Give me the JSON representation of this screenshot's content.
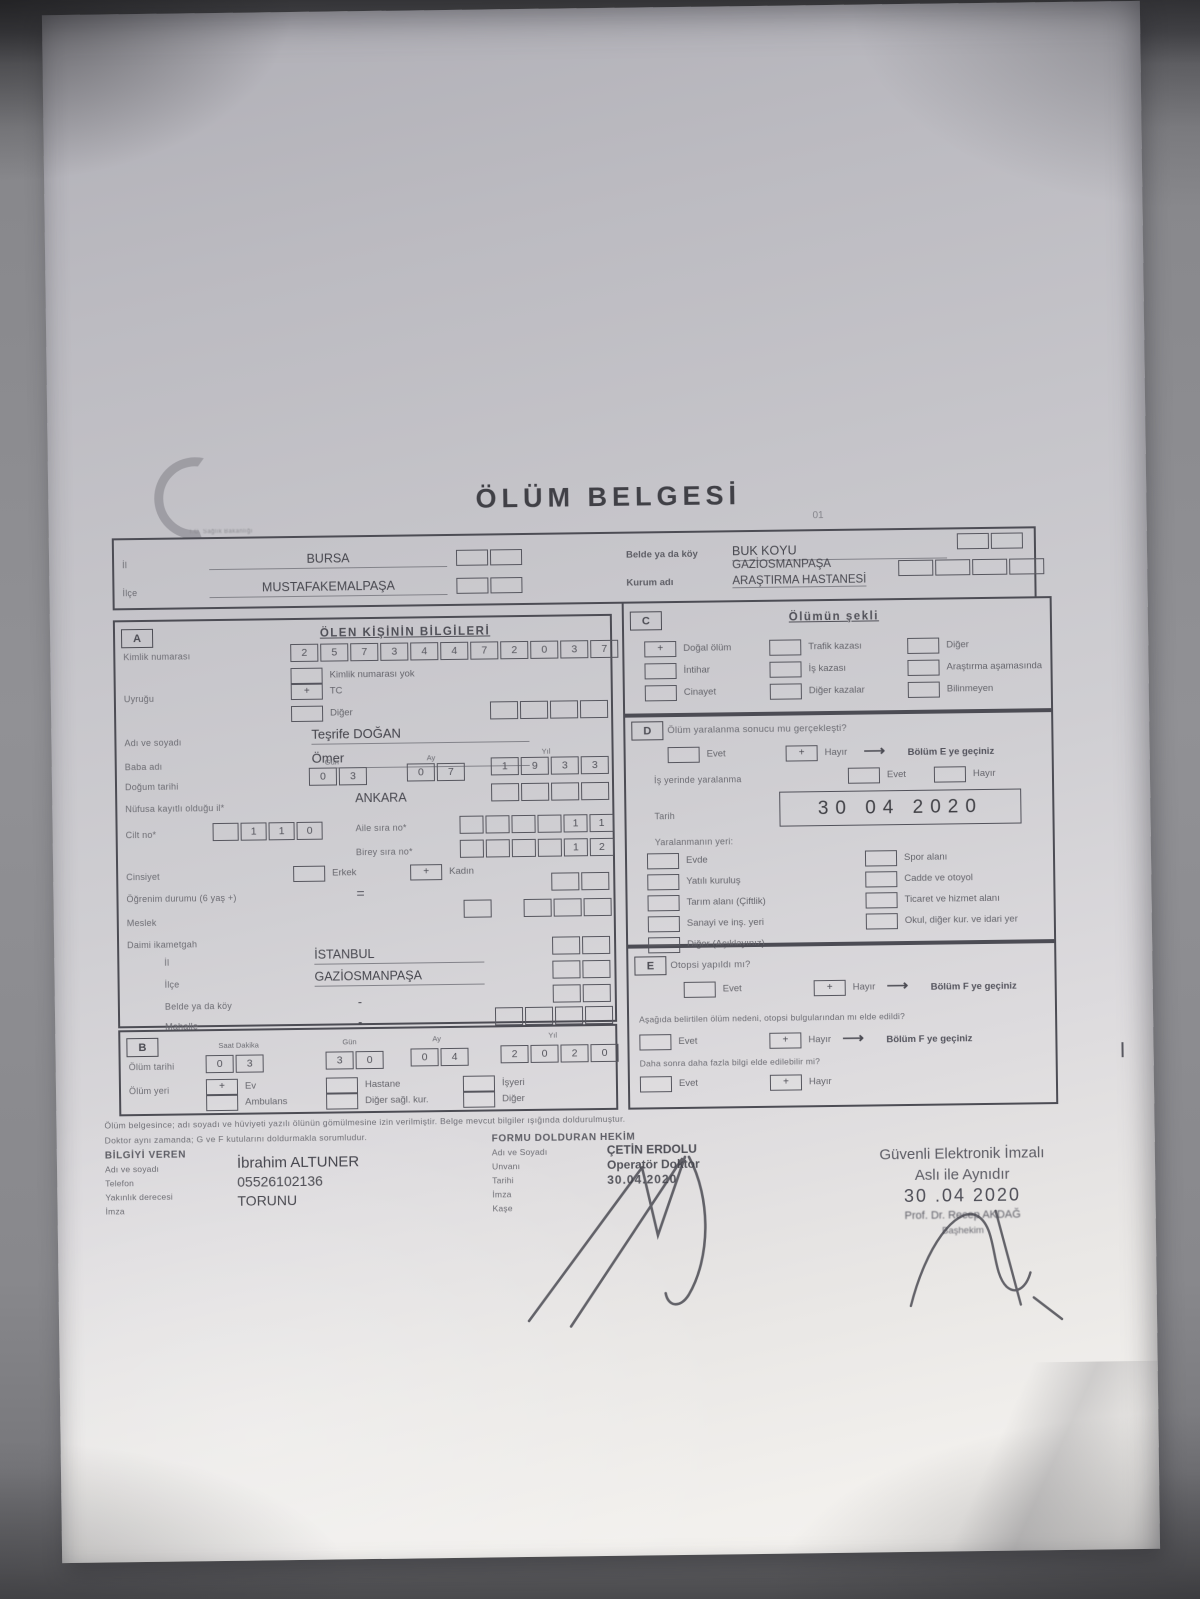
{
  "header": {
    "title": "ÖLÜM BELGESİ",
    "page_code": "01",
    "logo_caption": "T.C. Sağlık Bakanlığı"
  },
  "top_box": {
    "il_label": "İl",
    "il_value": "BURSA",
    "ilce_label": "İlçe",
    "ilce_value": "MUSTAFAKEMALPAŞA",
    "belde_label": "Belde ya da köy",
    "belde_value": "BUK KOYU",
    "kurum_label": "Kurum adı",
    "kurum_value1": "GAZİOSMANPAŞA",
    "kurum_value2": "ARAŞTIRMA HASTANESİ"
  },
  "section_a": {
    "letter": "A",
    "title": "ÖLEN KİŞİNİN BİLGİLERİ",
    "id_label": "Kimlik numarası",
    "id_digits": [
      "2",
      "5",
      "7",
      "3",
      "4",
      "4",
      "7",
      "2",
      "0",
      "3",
      "7"
    ],
    "no_id_label": "Kimlik numarası yok",
    "nationality_label": "Uyruğu",
    "tc_label": "TC",
    "tc_mark": "+",
    "other_label": "Diğer",
    "name_label": "Adı ve soyadı",
    "name_value": "Teşrife DOĞAN",
    "father_label": "Baba adı",
    "father_value": "Ömer",
    "birth_label": "Doğum tarihi",
    "col_day": "Gün",
    "col_month": "Ay",
    "col_year": "Yıl",
    "birth_day": [
      "0",
      "3"
    ],
    "birth_month": [
      "0",
      "7"
    ],
    "birth_year": [
      "1",
      "9",
      "3",
      "3"
    ],
    "registry_label": "Nüfusa kayıtlı olduğu il*",
    "registry_value": "ANKARA",
    "cilt_label": "Cilt no*",
    "cilt_digits": [
      "",
      "1",
      "1",
      "0"
    ],
    "aile_label": "Aile sıra no*",
    "aile_digits": [
      "",
      "",
      "",
      "",
      "1",
      "1"
    ],
    "birey_label": "Birey sıra no*",
    "birey_digits": [
      "",
      "",
      "",
      "",
      "1",
      "2"
    ],
    "gender_label": "Cinsiyet",
    "male_label": "Erkek",
    "female_label": "Kadın",
    "female_mark": "+",
    "education_label": "Öğrenim durumu (6 yaş +)",
    "education_value": "=",
    "occupation_label": "Meslek",
    "residence_label": "Daimi ikametgah",
    "res_il_label": "İl",
    "res_il_value": "İSTANBUL",
    "res_ilce_label": "İlçe",
    "res_ilce_value": "GAZİOSMANPAŞA",
    "res_belde_label": "Belde ya da köy",
    "res_belde_value": "-",
    "res_mahalle_label": "Mahalle",
    "res_mahalle_value": "-"
  },
  "section_b": {
    "letter": "B",
    "col_time": "Saat  Dakika",
    "col_day": "Gün",
    "col_month": "Ay",
    "col_year": "Yıl",
    "date_label": "Ölüm tarihi",
    "time_digits": [
      "0",
      "3"
    ],
    "day_digits": [
      "3",
      "0"
    ],
    "month_digits": [
      "0",
      "4"
    ],
    "year_digits": [
      "2",
      "0",
      "2",
      "0"
    ],
    "place_label": "Ölüm yeri",
    "ev_mark": "+",
    "opt_ev": "Ev",
    "opt_hastane": "Hastane",
    "opt_isyeri": "İşyeri",
    "opt_ambulans": "Ambulans",
    "opt_diger_saglik": "Diğer sağl. kur.",
    "opt_diger": "Diğer"
  },
  "section_c": {
    "letter": "C",
    "title": "Ölümün şekli",
    "dogal_mark": "+",
    "o1": "Doğal ölüm",
    "o2": "İntihar",
    "o3": "Cinayet",
    "o4": "Trafik kazası",
    "o5": "İş kazası",
    "o6": "Diğer kazalar",
    "o7": "Diğer",
    "o8": "Araştırma aşamasında",
    "o9": "Bilinmeyen"
  },
  "section_d": {
    "letter": "D",
    "question": "Ölüm yaralanma sonucu mu gerçekleşti?",
    "yes_label": "Evet",
    "no_label": "Hayır",
    "no_mark": "+",
    "goto_e": "Bölüm E ye geçiniz",
    "work_label": "İş yerinde yaralanma",
    "date_label": "Tarih",
    "date_value": "30   04   2020",
    "place_label": "Yaralanmanın yeri:",
    "l1": "Evde",
    "l2": "Yatılı kuruluş",
    "l3": "Tarım alanı (Çiftlik)",
    "l4": "Sanayi ve inş. yeri",
    "l5": "Diğer (Açıklayınız)",
    "r1": "Spor alanı",
    "r2": "Cadde ve otoyol",
    "r3": "Ticaret ve hizmet alanı",
    "r4": "Okul, diğer kur. ve idari yer"
  },
  "section_e": {
    "letter": "E",
    "q1": "Otopsi yapıldı mı?",
    "yes_label": "Evet",
    "no_label": "Hayır",
    "no_mark": "+",
    "goto_f": "Bölüm F ye geçiniz",
    "q2": "Aşağıda belirtilen ölüm nedeni, otopsi bulgularından mı elde edildi?",
    "q3": "Daha sonra daha fazla bilgi elde edilebilir mi?"
  },
  "footer": {
    "note1": "Ölüm belgesince; adı soyadı ve hüviyeti yazılı ölünün gömülmesine izin verilmiştir. Belge mevcut bilgiler ışığında doldurulmuştur.",
    "note2": "Doktor aynı zamanda; G ve F kutularını doldurmakla sorumludur.",
    "informant": {
      "title": "BİLGİYİ VEREN",
      "l_name": "Adı ve soyadı",
      "l_phone": "Telefon",
      "l_relation": "Yakınlık derecesi",
      "l_sign": "İmza",
      "v_name": "İbrahim ALTUNER",
      "v_phone": "05526102136",
      "v_relation": "TORUNU"
    },
    "physician": {
      "title": "FORMU DOLDURAN HEKİM",
      "l_name": "Adı ve Soyadı",
      "l_title": "Unvanı",
      "l_date": "Tarihi",
      "l_sign": "İmza",
      "l_stamp": "Kaşe",
      "v_name": "ÇETİN ERDOLU",
      "v_title": "Operatör Doktor",
      "v_date": "30.04.2020"
    },
    "stamp": {
      "l1": "Güvenli Elektronik İmzalı",
      "l2": "Aslı ile Aynıdır",
      "l3": "30 .04 2020",
      "l4": "Prof. Dr. Recep AKDAĞ",
      "l5": "Başhekim"
    }
  }
}
